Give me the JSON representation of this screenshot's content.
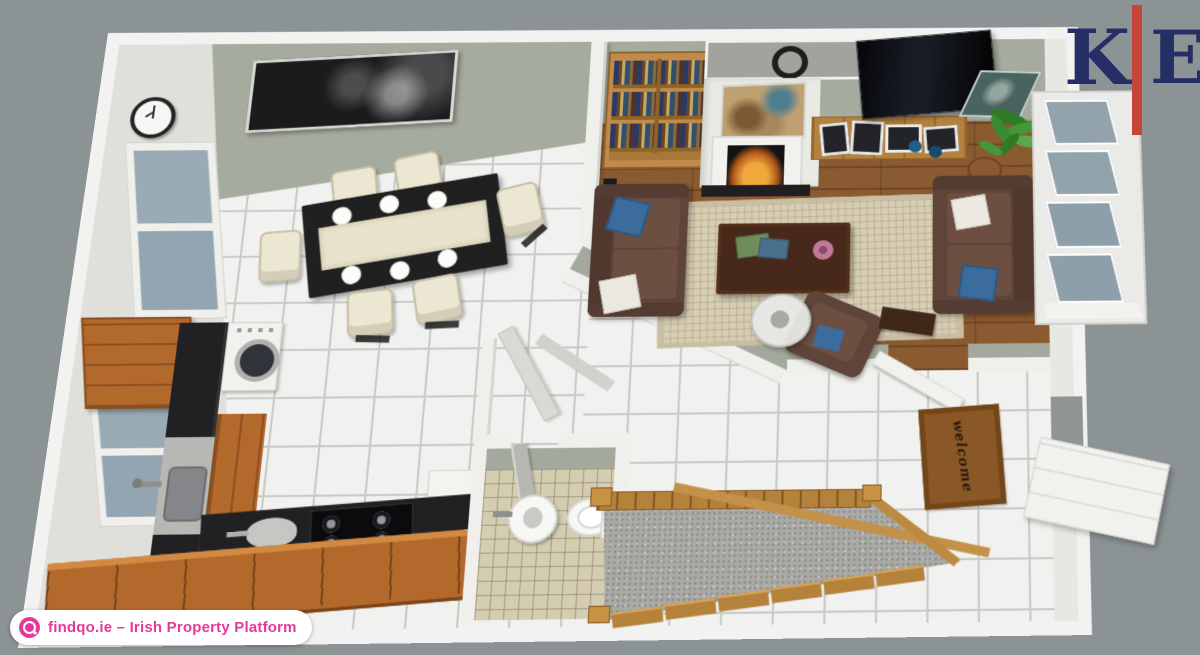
{
  "branding": {
    "logo": {
      "letter_left": "K",
      "letter_right": "E",
      "navy": "#252f66",
      "red": "#c5453a"
    },
    "watermark": {
      "text": "findqo.ie – Irish Property Platform",
      "accent_pink": "#e5399a",
      "icon": "globe-icon"
    }
  },
  "floor_plan": {
    "view": "3d-dollhouse-top-view",
    "doormat_text": "welcome",
    "rooms": [
      {
        "name": "dining-room",
        "floor": "white-tile",
        "items": [
          "dining-table",
          "six-cream-chairs",
          "wall-clock",
          "dark-wall-art",
          "two-windows"
        ]
      },
      {
        "name": "kitchen",
        "floor": "white-tile",
        "items": [
          "l-shaped-black-counter",
          "sink",
          "washing-machine",
          "cooktop",
          "wood-wall-cabinet",
          "window"
        ]
      },
      {
        "name": "living-room",
        "floor": "hardwood",
        "items": [
          "bookshelf",
          "fireplace",
          "overmantel-wreath",
          "map-art",
          "tv",
          "tv-stand-photos",
          "sofa-left",
          "sofa-right",
          "rug",
          "coffee-table",
          "armchair",
          "round-glass-table",
          "potted-plant",
          "bay-windows"
        ]
      },
      {
        "name": "bathroom",
        "floor": "beige-checker-tile",
        "items": [
          "pedestal-sink",
          "toilet",
          "door"
        ]
      },
      {
        "name": "hallway",
        "floor": "white-tile",
        "items": [
          "staircase",
          "doormat",
          "front-door",
          "open-doors"
        ]
      }
    ],
    "colors": {
      "background": "#8c9394",
      "outer_walls": "#f2f2f0",
      "wall_face": "#a4a99e",
      "hardwood": "#8a5a30",
      "cabinet_wood": "#b4692c",
      "countertop": "#212124",
      "sofa_brown": "#5f443a",
      "rug_beige": "#d7ceb4",
      "window_glass": "#97a7b1",
      "stairs_carpet": "#a9a9a5",
      "accent_pillow_blue": "#3c6c9c",
      "fire_glow": "#f0a83c"
    }
  }
}
